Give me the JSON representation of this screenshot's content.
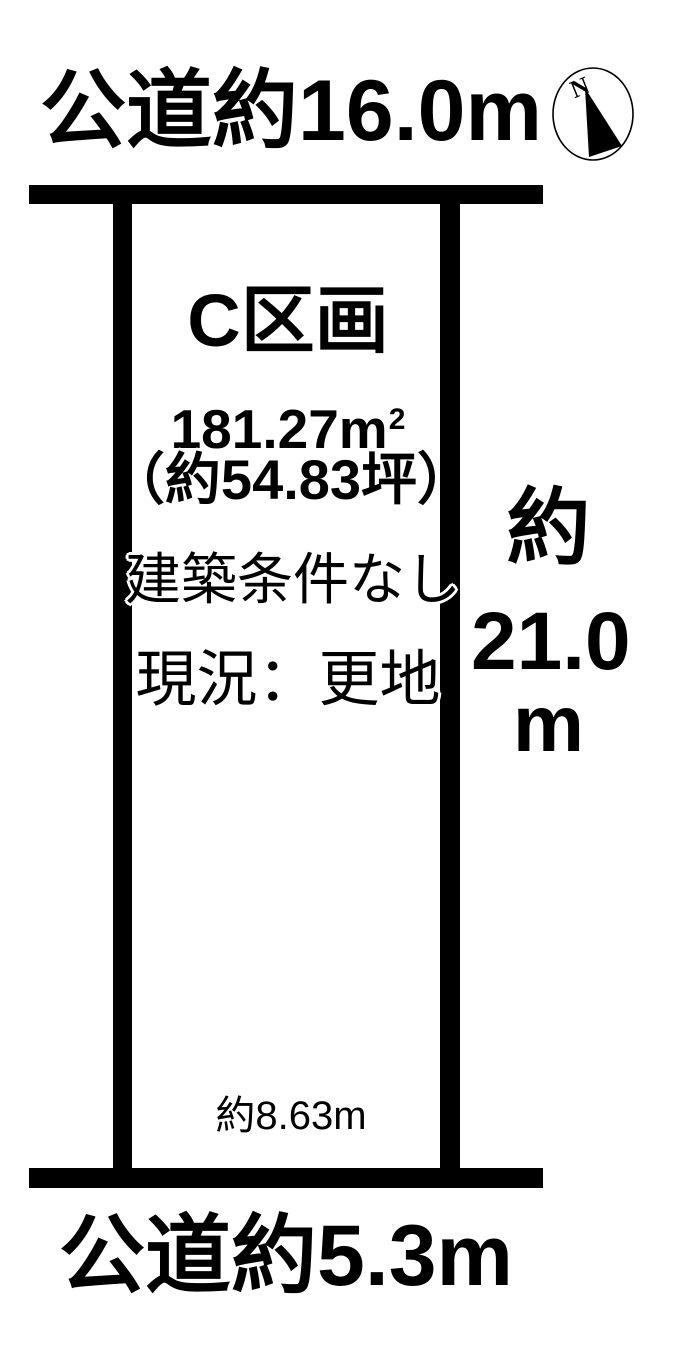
{
  "diagram": {
    "top_road_label": "公道約16.0m",
    "bottom_road_label": "公道約5.3m",
    "compass": {
      "letter": "N"
    },
    "plot": {
      "name": "C区画",
      "area_sqm": "181.27m",
      "area_sqm_sup": "2",
      "area_tsubo": "（約54.83坪）",
      "condition": "建築条件なし",
      "status": "現況：更地",
      "bottom_width_label": "約8.63m"
    },
    "right_dimension": {
      "line1": "約",
      "line2": "21.0",
      "line3": "m"
    },
    "colors": {
      "line": "#000000",
      "background": "#ffffff",
      "text": "#000000"
    }
  }
}
